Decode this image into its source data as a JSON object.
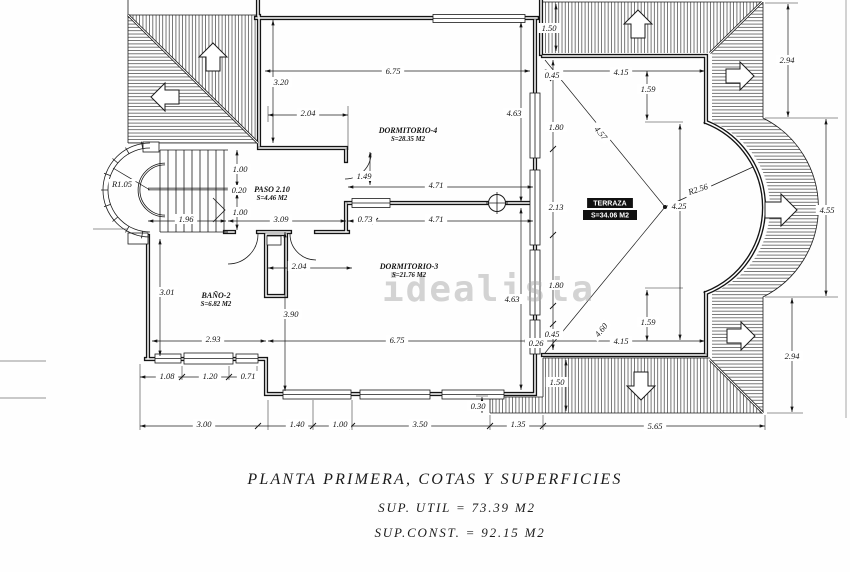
{
  "watermark": "idealista",
  "title_block": {
    "line1": "PLANTA PRIMERA, COTAS Y SUPERFICIES",
    "line2": "SUP. UTIL = 73.39 M2",
    "line3": "SUP.CONST. = 92.15 M2"
  },
  "plan": {
    "rooms": [
      {
        "name": "DORMITORIO-4",
        "area": "S=28.35 M2",
        "x": 408,
        "y": 130,
        "inverse": false
      },
      {
        "name": "DORMITORIO-3",
        "area": "S=21.76 M2",
        "x": 409,
        "y": 266,
        "inverse": false
      },
      {
        "name": "PASO 2.10",
        "area": "S=4.46 M2",
        "x": 272,
        "y": 189,
        "inverse": false
      },
      {
        "name": "BAÑO-2",
        "area": "S=6.82 M2",
        "x": 216,
        "y": 295,
        "inverse": false
      },
      {
        "name": "TERRAZA",
        "area": "S=34.06 M2",
        "x": 610,
        "y": 203,
        "inverse": true
      }
    ],
    "dimensions": [
      {
        "t": "6.75",
        "x": 393,
        "y": 71
      },
      {
        "t": "3.20",
        "x": 281,
        "y": 82
      },
      {
        "t": "2.04",
        "x": 308,
        "y": 113
      },
      {
        "t": "1.00",
        "x": 240,
        "y": 169
      },
      {
        "t": "0.20",
        "x": 239,
        "y": 190
      },
      {
        "t": "1.00",
        "x": 240,
        "y": 212
      },
      {
        "t": "R1.05",
        "x": 122,
        "y": 184
      },
      {
        "t": "1.96",
        "x": 186,
        "y": 219
      },
      {
        "t": "3.09",
        "x": 281,
        "y": 219
      },
      {
        "t": "0.73",
        "x": 365,
        "y": 219
      },
      {
        "t": "1.49",
        "x": 364,
        "y": 176
      },
      {
        "t": "4.71",
        "x": 436,
        "y": 185
      },
      {
        "t": "4.71",
        "x": 436,
        "y": 219
      },
      {
        "t": "2.04",
        "x": 299,
        "y": 266
      },
      {
        "t": "3.01",
        "x": 167,
        "y": 292
      },
      {
        "t": "3.90",
        "x": 291,
        "y": 314
      },
      {
        "t": "2.93",
        "x": 213,
        "y": 339
      },
      {
        "t": "6.75",
        "x": 397,
        "y": 340
      },
      {
        "t": "1.08",
        "x": 167,
        "y": 376
      },
      {
        "t": "1.20",
        "x": 210,
        "y": 376
      },
      {
        "t": "0.71",
        "x": 248,
        "y": 376
      },
      {
        "t": "3.00",
        "x": 204,
        "y": 424
      },
      {
        "t": "1.40",
        "x": 297,
        "y": 424
      },
      {
        "t": "1.00",
        "x": 340,
        "y": 424
      },
      {
        "t": "3.50",
        "x": 420,
        "y": 424
      },
      {
        "t": "1.35",
        "x": 518,
        "y": 424
      },
      {
        "t": "5.65",
        "x": 655,
        "y": 426
      },
      {
        "t": "0.30",
        "x": 478,
        "y": 406
      },
      {
        "t": "0.26",
        "x": 536,
        "y": 343
      },
      {
        "t": "0.45",
        "x": 552,
        "y": 334
      },
      {
        "t": "4.63",
        "x": 514,
        "y": 113
      },
      {
        "t": "1.80",
        "x": 556,
        "y": 127
      },
      {
        "t": "2.13",
        "x": 556,
        "y": 207
      },
      {
        "t": "1.80",
        "x": 556,
        "y": 285
      },
      {
        "t": "4.63",
        "x": 512,
        "y": 299
      },
      {
        "t": "0.45",
        "x": 552,
        "y": 75
      },
      {
        "t": "1.50",
        "x": 549,
        "y": 28
      },
      {
        "t": "1.50",
        "x": 557,
        "y": 382
      },
      {
        "t": "4.15",
        "x": 621,
        "y": 72
      },
      {
        "t": "1.59",
        "x": 648,
        "y": 89
      },
      {
        "t": "4.57",
        "x": 601,
        "y": 133,
        "r": 50
      },
      {
        "t": "R2.56",
        "x": 698,
        "y": 189,
        "r": -18
      },
      {
        "t": "4.25",
        "x": 679,
        "y": 206
      },
      {
        "t": "4.60",
        "x": 601,
        "y": 330,
        "r": -51
      },
      {
        "t": "1.59",
        "x": 648,
        "y": 322
      },
      {
        "t": "4.15",
        "x": 621,
        "y": 341
      },
      {
        "t": "2.94",
        "x": 787,
        "y": 60
      },
      {
        "t": "4.55",
        "x": 827,
        "y": 210
      },
      {
        "t": "2.94",
        "x": 792,
        "y": 356
      }
    ]
  }
}
